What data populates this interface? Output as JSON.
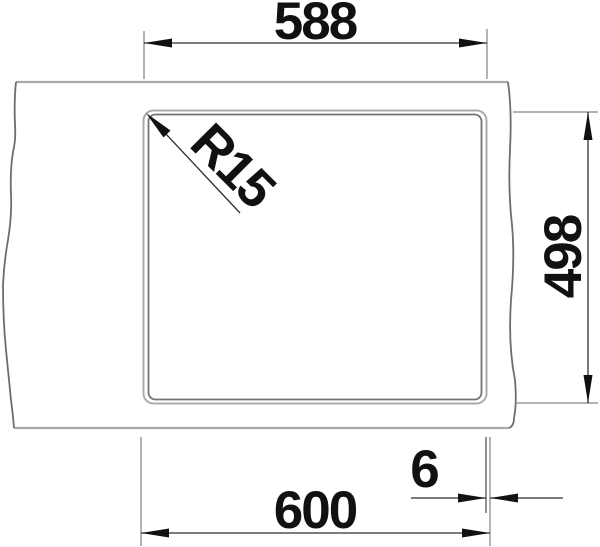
{
  "diagram": {
    "type": "technical-drawing",
    "subject": "sink-cutout-installation-top-view",
    "dimensions": {
      "top_width": {
        "label": "588",
        "orientation": "horizontal"
      },
      "right_height": {
        "label": "498",
        "orientation": "vertical-rotated"
      },
      "bottom_width": {
        "label": "600",
        "orientation": "horizontal"
      },
      "edge_offset": {
        "label": "6",
        "orientation": "horizontal"
      },
      "corner_radius": {
        "label": "R15",
        "orientation": "diagonal-45deg"
      }
    },
    "colors": {
      "background": "#ffffff",
      "counter_line": "#a9a9a9",
      "break_line": "#6e6e6e",
      "bowl_outer_line": "#ababab",
      "bowl_inner_line": "#747474",
      "extension_line": "#9b9b9b",
      "dimension_line": "#2f2f2f",
      "arrow_fill": "#111111",
      "text": "#111111"
    }
  }
}
